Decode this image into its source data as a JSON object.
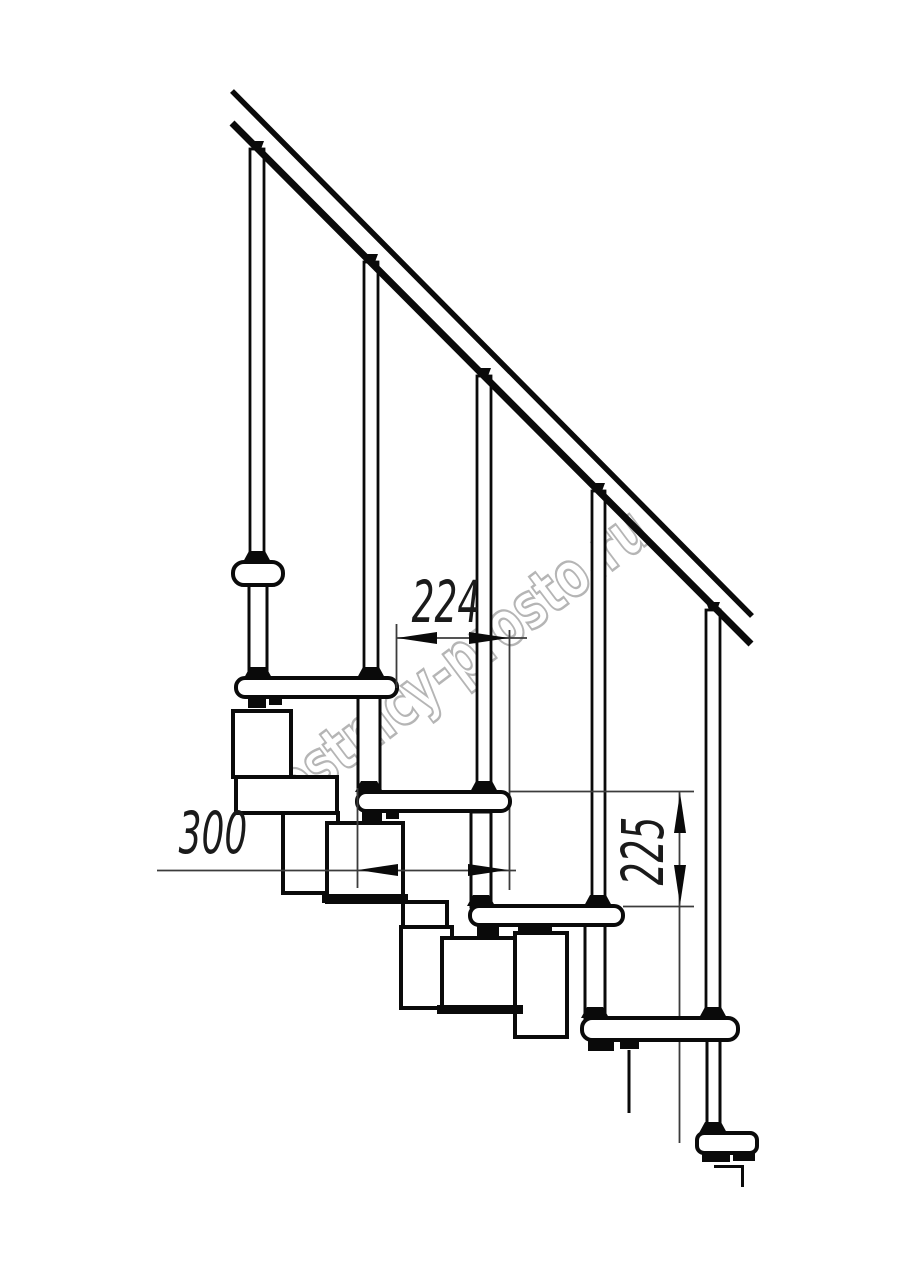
{
  "title": "Modular staircase side elevation drawing",
  "watermark": {
    "text": "lestnicy-prosto.ru",
    "color": "#b5b5b5"
  },
  "dimensions": {
    "going_224": {
      "value": "224",
      "orientation": "horizontal"
    },
    "tread_depth_300": {
      "value": "300",
      "orientation": "horizontal"
    },
    "rise_225": {
      "value": "225",
      "orientation": "vertical"
    }
  },
  "drawing": {
    "canvas": {
      "w": 914,
      "h": 1280,
      "bg": "#ffffff",
      "ink": "#0a0a0a",
      "dim_color": "#3c3c3c"
    },
    "layers": [
      {
        "type": "line",
        "stroke": "#3c3c3c",
        "sw": 1.8,
        "items": [
          {
            "n": "ext-line-shared-right-behind",
            "x1": 509.5,
            "y1": 630,
            "x2": 509.5,
            "y2": 890
          },
          {
            "n": "dim-225-tail-behind",
            "x1": 679.5,
            "y1": 906,
            "x2": 679.5,
            "y2": 1143
          }
        ]
      },
      {
        "type": "rect",
        "stroke": "#0a0a0a",
        "sw": 4,
        "fill": "#ffffff",
        "items": [
          {
            "n": "module-under-tread-2-upper",
            "x": 233,
            "y": 711,
            "w": 58,
            "h": 66
          },
          {
            "n": "module-connector-1",
            "x": 236,
            "y": 777,
            "w": 101,
            "h": 36
          },
          {
            "n": "module-lower-1",
            "x": 283,
            "y": 813,
            "w": 55,
            "h": 80
          },
          {
            "n": "module-under-tread-3-upper",
            "x": 327,
            "y": 823,
            "w": 76,
            "h": 79
          },
          {
            "n": "module-connector-2",
            "x": 403,
            "y": 902,
            "w": 44,
            "h": 25
          },
          {
            "n": "module-lower-2",
            "x": 401,
            "y": 927,
            "w": 51,
            "h": 81
          },
          {
            "n": "module-under-tread-4-upper",
            "x": 442,
            "y": 938,
            "w": 76,
            "h": 69
          },
          {
            "n": "module-lower-3",
            "x": 515,
            "y": 933,
            "w": 52,
            "h": 104
          }
        ]
      },
      {
        "type": "rect",
        "fill": "#0a0a0a",
        "sw": 0,
        "items": [
          {
            "n": "module-2-base-bar",
            "x": 322,
            "y": 894,
            "w": 86,
            "h": 9
          },
          {
            "n": "module-3-base-bar",
            "x": 437,
            "y": 1005,
            "w": 86,
            "h": 9
          }
        ]
      },
      {
        "type": "rect",
        "stroke": "#0a0a0a",
        "sw": 3,
        "fill": "#ffffff",
        "items": [
          {
            "n": "support-column-1",
            "x": 249,
            "y": 585,
            "w": 18,
            "h": 93
          },
          {
            "n": "support-column-2",
            "x": 358,
            "y": 697,
            "w": 22,
            "h": 96
          },
          {
            "n": "support-column-3",
            "x": 471,
            "y": 812,
            "w": 20,
            "h": 95
          },
          {
            "n": "support-column-4",
            "x": 585,
            "y": 925,
            "w": 20,
            "h": 94
          },
          {
            "n": "support-column-5",
            "x": 707,
            "y": 1040,
            "w": 13,
            "h": 93
          }
        ]
      },
      {
        "type": "rect",
        "stroke": "#0a0a0a",
        "sw": 2.8,
        "fill": "#ffffff",
        "items": [
          {
            "n": "baluster-1",
            "x": 250,
            "y": 149,
            "w": 14,
            "h": 413
          },
          {
            "n": "baluster-2",
            "x": 364,
            "y": 262,
            "w": 14,
            "h": 416
          },
          {
            "n": "baluster-3",
            "x": 477,
            "y": 376,
            "w": 14,
            "h": 416
          },
          {
            "n": "baluster-4",
            "x": 592,
            "y": 491,
            "w": 13,
            "h": 415
          },
          {
            "n": "baluster-5",
            "x": 706,
            "y": 610,
            "w": 14,
            "h": 408
          }
        ]
      },
      {
        "type": "rect",
        "stroke": "#0a0a0a",
        "sw": 4,
        "fill": "#ffffff",
        "items": [
          {
            "n": "tread-1",
            "x": 233,
            "y": 562,
            "w": 50,
            "h": 23,
            "rx": 11
          },
          {
            "n": "tread-2",
            "x": 236,
            "y": 678,
            "w": 161,
            "h": 19,
            "rx": 9
          },
          {
            "n": "tread-3",
            "x": 357,
            "y": 792,
            "w": 153,
            "h": 19,
            "rx": 9
          },
          {
            "n": "tread-4",
            "x": 470,
            "y": 906,
            "w": 153,
            "h": 19,
            "rx": 9
          },
          {
            "n": "tread-5",
            "x": 582,
            "y": 1018,
            "w": 156,
            "h": 22,
            "rx": 10
          },
          {
            "n": "floor-base-plate",
            "x": 697,
            "y": 1133,
            "w": 60,
            "h": 20,
            "rx": 7
          }
        ]
      },
      {
        "type": "line",
        "stroke": "#0a0a0a",
        "sw": 3,
        "items": [
          {
            "n": "support-cut-line",
            "x1": 629,
            "y1": 1050,
            "x2": 629,
            "y2": 1113
          },
          {
            "n": "floor-cut-line-h",
            "x1": 714,
            "y1": 1166.5,
            "x2": 742,
            "y2": 1166.5
          },
          {
            "n": "floor-cut-line-v",
            "x1": 742.5,
            "y1": 1165,
            "x2": 742.5,
            "y2": 1187
          }
        ]
      },
      {
        "type": "rect",
        "fill": "#0a0a0a",
        "sw": 0,
        "items": [
          {
            "n": "bracket-foot-1a",
            "x": 248,
            "y": 697,
            "w": 18,
            "h": 11
          },
          {
            "n": "bracket-foot-1b",
            "x": 269,
            "y": 697,
            "w": 13,
            "h": 8
          },
          {
            "n": "bracket-foot-2a",
            "x": 362,
            "y": 811,
            "w": 20,
            "h": 11
          },
          {
            "n": "bracket-foot-2b",
            "x": 386,
            "y": 811,
            "w": 13,
            "h": 8
          },
          {
            "n": "bracket-foot-3a",
            "x": 477,
            "y": 925,
            "w": 22,
            "h": 11
          },
          {
            "n": "bracket-foot-3b",
            "x": 518,
            "y": 927,
            "w": 34,
            "h": 8
          },
          {
            "n": "bracket-foot-4a",
            "x": 588,
            "y": 1040,
            "w": 26,
            "h": 11
          },
          {
            "n": "bracket-foot-4b",
            "x": 620,
            "y": 1041,
            "w": 19,
            "h": 8
          },
          {
            "n": "base-foot-a",
            "x": 702,
            "y": 1152,
            "w": 28,
            "h": 10
          },
          {
            "n": "base-foot-b",
            "x": 733,
            "y": 1152,
            "w": 22,
            "h": 9
          }
        ]
      },
      {
        "type": "poly",
        "fill": "#0a0a0a",
        "items": [
          {
            "n": "collar-baluster-1",
            "p": "249,551 265,551 271,562 243,562"
          },
          {
            "n": "collar-column-1",
            "p": "250,667 266,667 272,678 244,678"
          },
          {
            "n": "collar-baluster-2",
            "p": "363,667 379,667 385,678 357,678"
          },
          {
            "n": "collar-column-2",
            "p": "361,781 377,781 383,792 355,792"
          },
          {
            "n": "collar-baluster-3",
            "p": "476,781 492,781 498,792 470,792"
          },
          {
            "n": "collar-column-3",
            "p": "473,895 489,895 495,906 467,906"
          },
          {
            "n": "collar-baluster-4",
            "p": "590,895 606,895 612,906 584,906"
          },
          {
            "n": "collar-column-4",
            "p": "587,1007 603,1007 609,1018 581,1018"
          },
          {
            "n": "collar-baluster-5",
            "p": "705,1007 721,1007 727,1018 699,1018"
          },
          {
            "n": "collar-base",
            "p": "705,1122 721,1122 727,1133 699,1133"
          },
          {
            "n": "rail-collar-1",
            "p": "250,141 264,141 261,149 253,149"
          },
          {
            "n": "rail-collar-2",
            "p": "364,254 378,254 375,262 367,262"
          },
          {
            "n": "rail-collar-3",
            "p": "477,368 491,368 488,376 480,376"
          },
          {
            "n": "rail-collar-4",
            "p": "591,483 605,483 602,491 594,491"
          },
          {
            "n": "rail-collar-5",
            "p": "706,602 720,602 717,610 709,610"
          }
        ]
      },
      {
        "type": "line",
        "stroke": "#0a0a0a",
        "sw": 5.5,
        "items": [
          {
            "n": "handrail-top-edge",
            "x1": 232,
            "y1": 91,
            "x2": 752,
            "y2": 616
          },
          {
            "n": "handrail-bottom-edge",
            "x1": 232,
            "y1": 123,
            "x2": 751,
            "y2": 644,
            "sw": 7
          }
        ]
      },
      {
        "type": "line",
        "stroke": "#3c3c3c",
        "sw": 1.8,
        "items": [
          {
            "n": "ext-224-left",
            "x1": 396.5,
            "y1": 624,
            "x2": 396.5,
            "y2": 688
          },
          {
            "n": "dim-224-line",
            "x1": 396,
            "y1": 638,
            "x2": 527,
            "y2": 638
          },
          {
            "n": "dim-300-line",
            "x1": 157,
            "y1": 870.5,
            "x2": 516,
            "y2": 870.5
          },
          {
            "n": "ext-300-left",
            "x1": 357.5,
            "y1": 788,
            "x2": 357.5,
            "y2": 888
          },
          {
            "n": "ext-225-top",
            "x1": 510,
            "y1": 791.5,
            "x2": 694,
            "y2": 791.5
          },
          {
            "n": "ext-225-bottom",
            "x1": 623,
            "y1": 906.5,
            "x2": 694,
            "y2": 906.5
          },
          {
            "n": "dim-225-line",
            "x1": 679.5,
            "y1": 792,
            "x2": 679.5,
            "y2": 906
          }
        ]
      },
      {
        "type": "poly",
        "fill": "#0a0a0a",
        "items": [
          {
            "n": "arrow-224-left",
            "p": "397,638 437,632 437,644"
          },
          {
            "n": "arrow-224-right",
            "p": "509,638 469,632 469,644"
          },
          {
            "n": "arrow-300-left",
            "p": "358,870 398,864 398,876"
          },
          {
            "n": "arrow-300-right",
            "p": "508,870 468,864 468,876"
          },
          {
            "n": "arrow-225-up",
            "p": "680,793 674,833 686,833"
          },
          {
            "n": "arrow-225-down",
            "p": "680,905 674,865 686,865"
          }
        ]
      }
    ]
  }
}
